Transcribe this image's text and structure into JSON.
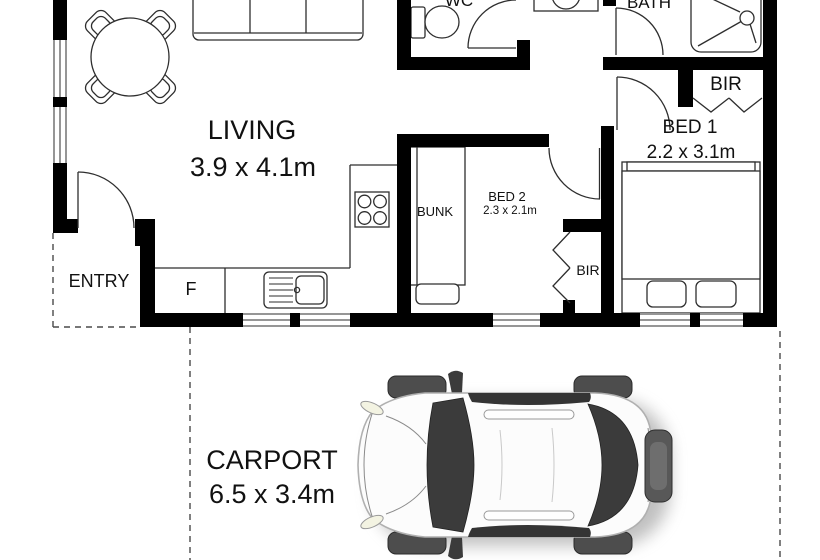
{
  "plan": {
    "rooms": {
      "living": {
        "name": "LIVING",
        "dims": "3.9 x 4.1m"
      },
      "entry": {
        "name": "ENTRY"
      },
      "wc": {
        "name": "WC"
      },
      "bath": {
        "name": "BATH"
      },
      "bed1": {
        "name": "BED 1",
        "dims": "2.2 x 3.1m"
      },
      "bed2": {
        "name": "BED 2",
        "dims": "2.3 x 2.1m"
      },
      "carport": {
        "name": "CARPORT",
        "dims": "6.5 x 3.4m"
      }
    },
    "fixtures": {
      "fridge_label": "F",
      "bunk_label": "BUNK",
      "bed1_robe_label": "BIR",
      "bed2_robe_label": "BIR"
    },
    "colors": {
      "wall": "#000000",
      "line": "#2e2e2e",
      "text": "#111111",
      "paper": "#ffffff",
      "car_glass": "#3b3b3b"
    }
  }
}
